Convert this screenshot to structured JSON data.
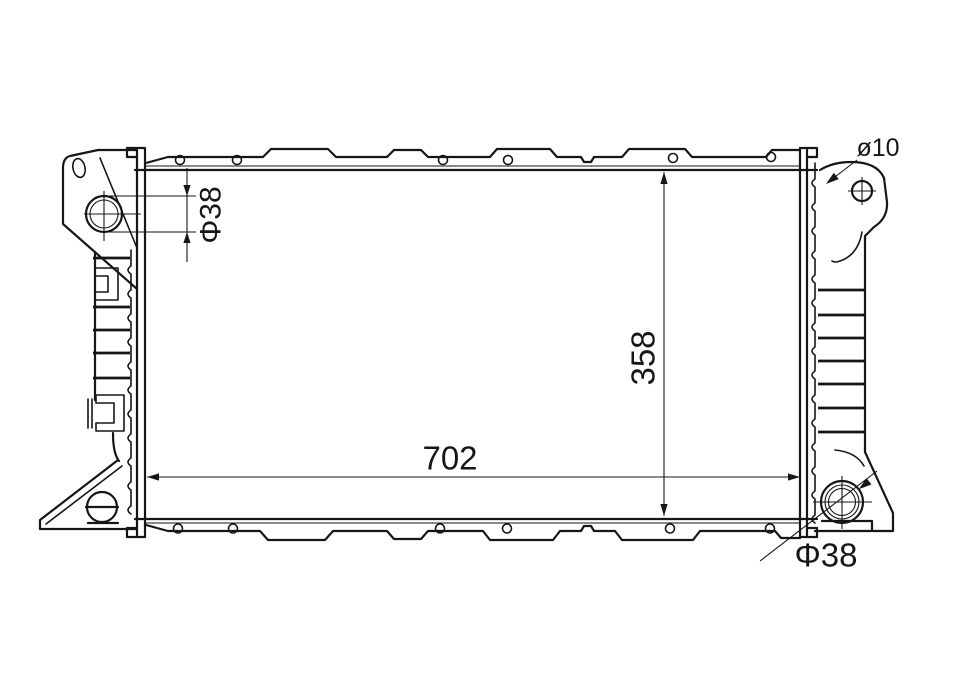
{
  "drawing": {
    "kind": "engineering-line-drawing",
    "subject": "automotive radiator front view with mounting brackets",
    "ink_color": "#161616",
    "background_color": "#ffffff",
    "annotations": {
      "inlet_diameter": "Φ38",
      "bracket_hole_diameter": "ø10",
      "core_height": "358",
      "core_width": "702",
      "outlet_diameter": "Φ38"
    }
  }
}
